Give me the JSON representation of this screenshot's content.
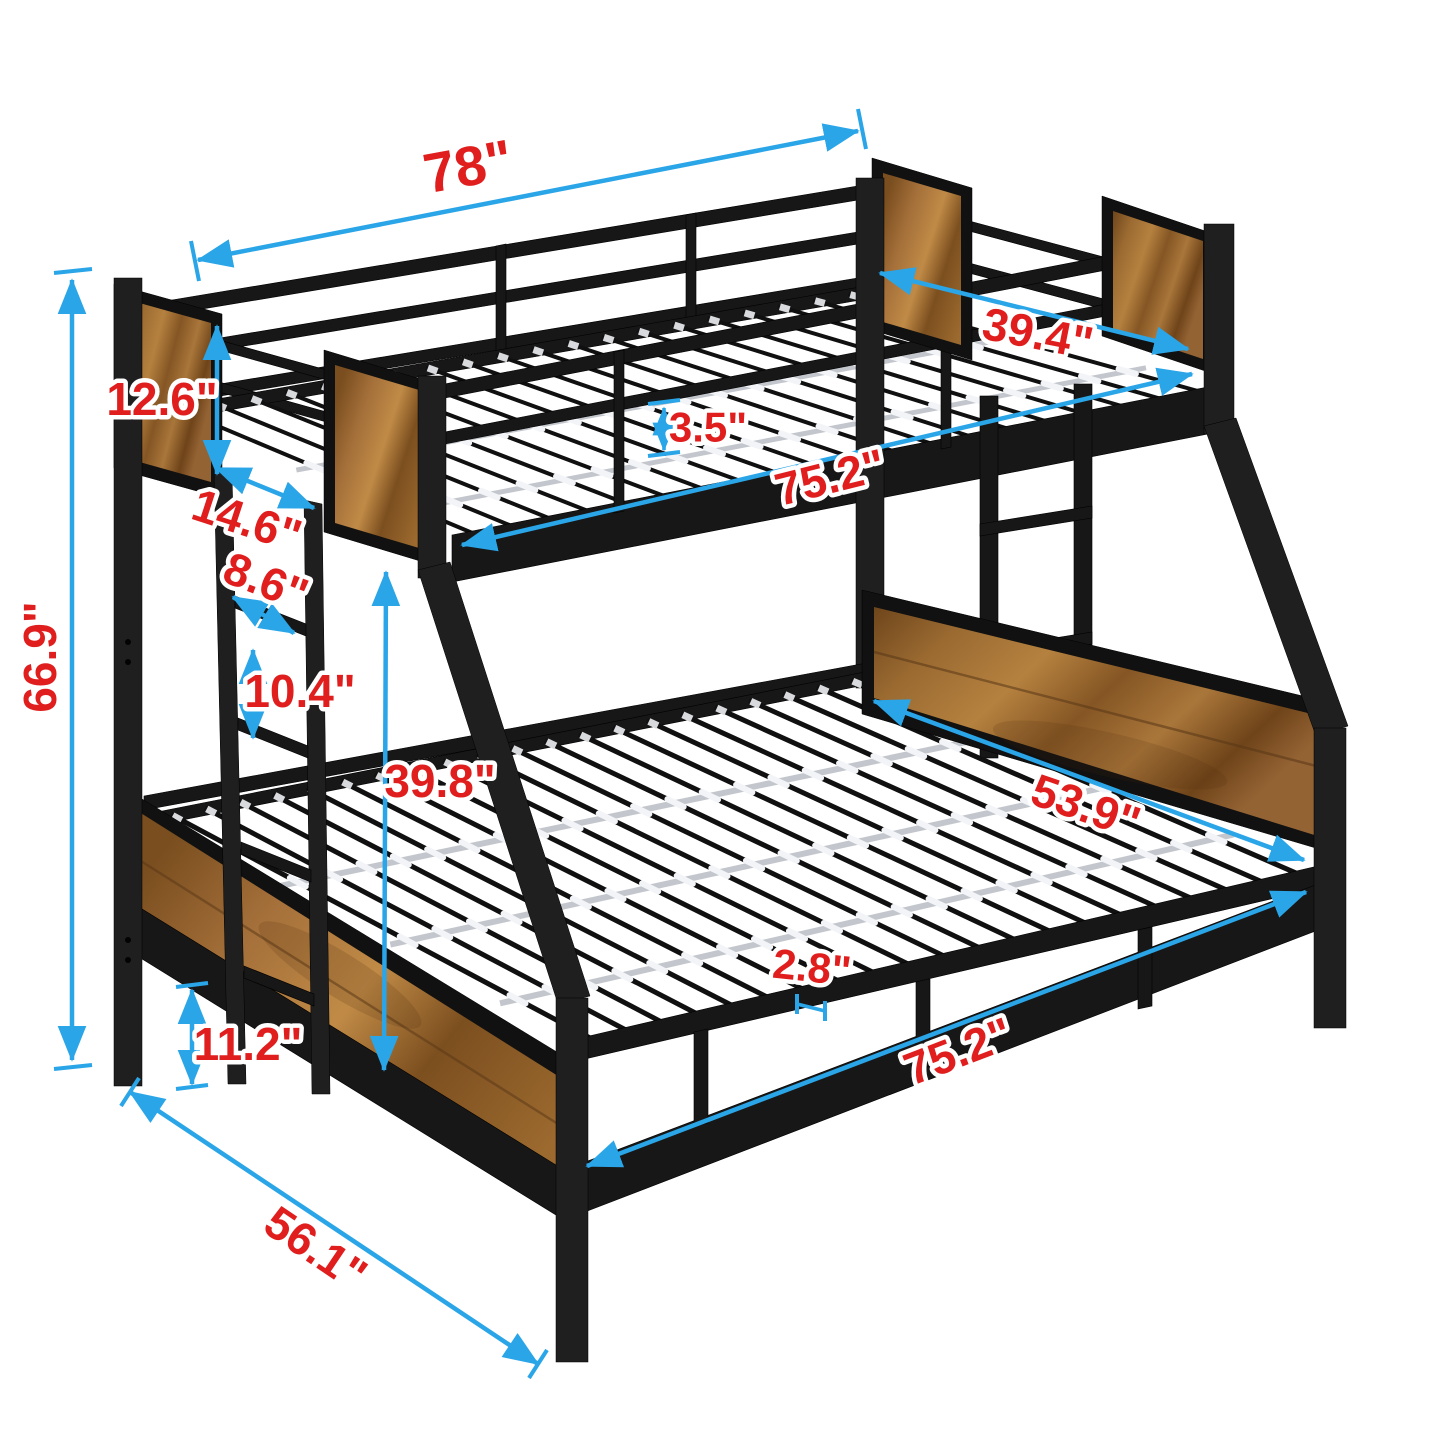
{
  "diagram": {
    "type": "product-dimension-diagram",
    "subject": "twin-over-full metal bunk bed with brown wood panel accents, front ladder, slat decks and angled legs",
    "background": "#ffffff",
    "annotation_colors": {
      "arrows": "#2AA5E7",
      "labels": "#E01E1E"
    },
    "bed_colors": {
      "frame": "#171717",
      "wood": "#9A6A33",
      "support_rods": "#C3C7CD",
      "rod_clips": "#F2F4F7"
    },
    "dimensions": {
      "top_frame_length": "78\"",
      "overall_height": "66.9\"",
      "top_panel_height": "12.6\"",
      "ladder_depth": "14.6\"",
      "ladder_rung_width": "8.6\"",
      "ladder_rung_spacing": "10.4\"",
      "bunk_clearance_height": "39.8\"",
      "guardrail_gap": "3.5\"",
      "top_bed_length": "75.2\"",
      "top_bed_width": "39.4\"",
      "bottom_bed_width": "53.9\"",
      "slat_spacing": "2.8\"",
      "bottom_bed_length": "75.2\"",
      "bottom_frame_height": "11.2\"",
      "overall_depth": "56.1\""
    }
  }
}
